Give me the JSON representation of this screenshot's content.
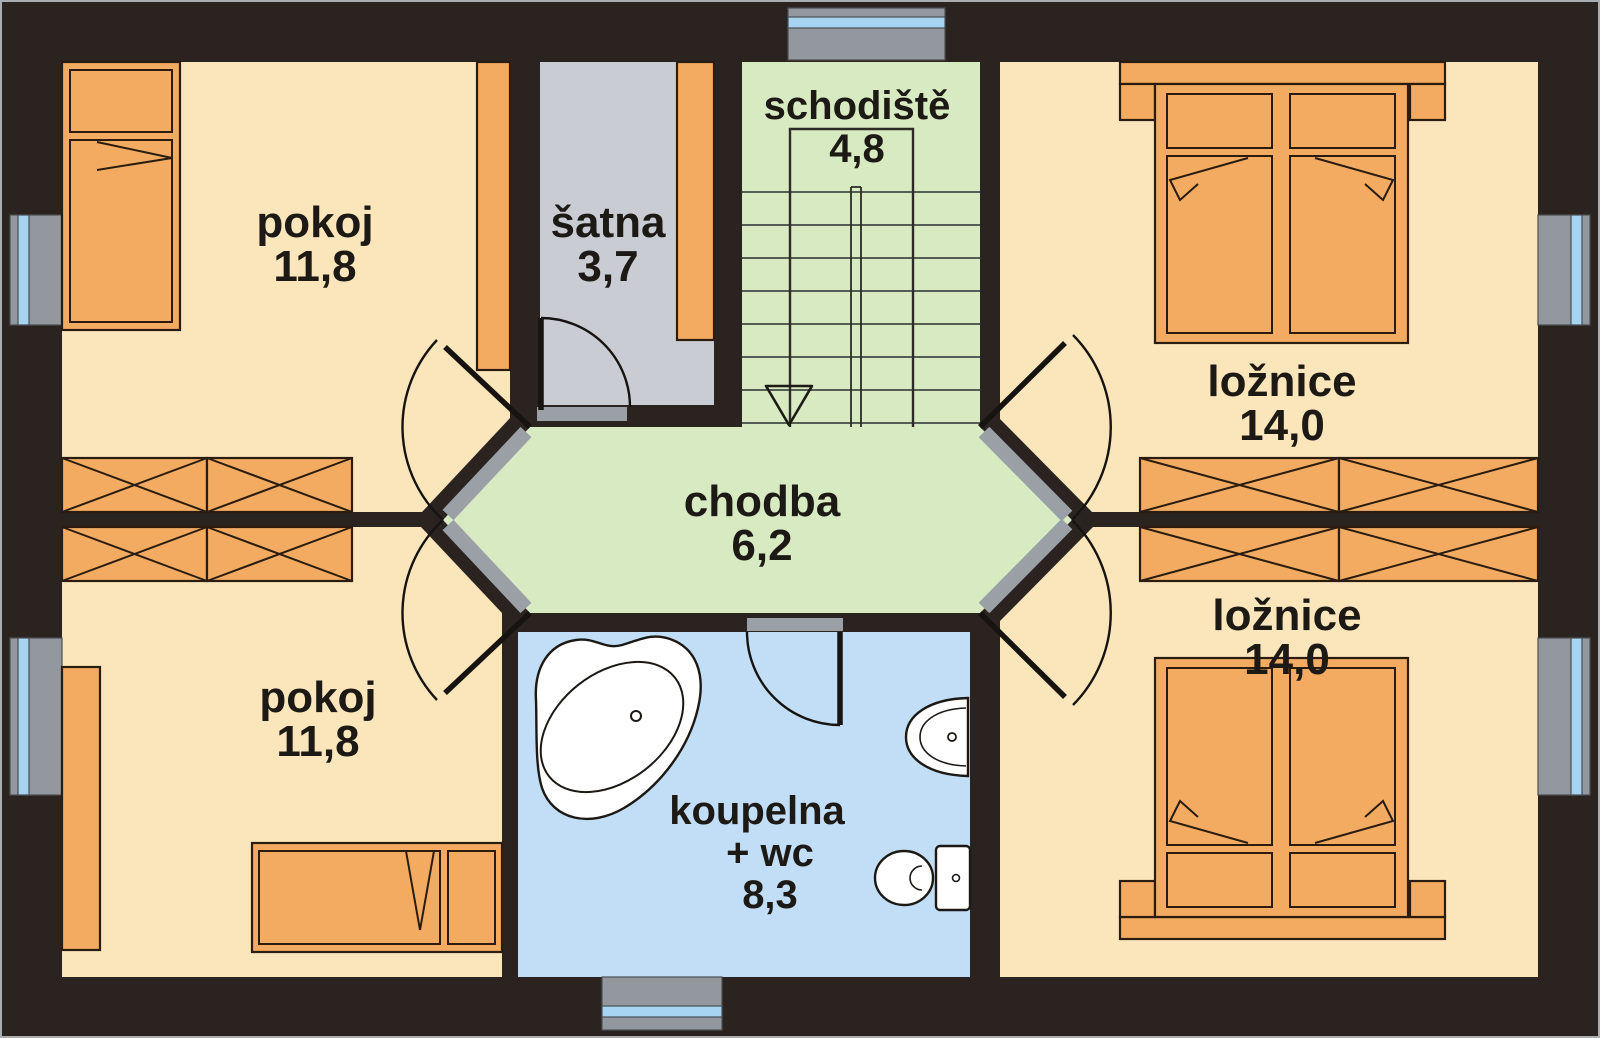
{
  "plan": {
    "type": "floor-plan",
    "rooms": [
      {
        "id": "pokoj-top-left",
        "label": "pokoj",
        "area": "11,8"
      },
      {
        "id": "satna",
        "label": "šatna",
        "area": "3,7"
      },
      {
        "id": "schodiste",
        "label": "schodiště",
        "area": "4,8"
      },
      {
        "id": "loznice-top-right",
        "label": "ložnice",
        "area": "14,0"
      },
      {
        "id": "chodba",
        "label": "chodba",
        "area": "6,2"
      },
      {
        "id": "pokoj-bottom-left",
        "label": "pokoj",
        "area": "11,8"
      },
      {
        "id": "koupelna",
        "label": "koupelna",
        "suffix": "+ wc",
        "area": "8,3"
      },
      {
        "id": "loznice-bottom-right",
        "label": "ložnice",
        "area": "14,0"
      }
    ]
  },
  "colors": {
    "wall": "#2a2320",
    "floor_room": "#fbe6bc",
    "floor_closet": "#c9cdd3",
    "floor_green": "#d8eac1",
    "floor_bath": "#c1def6",
    "furniture": "#f3ab62",
    "window_glass": "#a6d4f1",
    "window_frame": "#93989e",
    "threshold": "#9ba0a6",
    "fixture_white": "#ffffff",
    "text": "#1d1a16"
  }
}
